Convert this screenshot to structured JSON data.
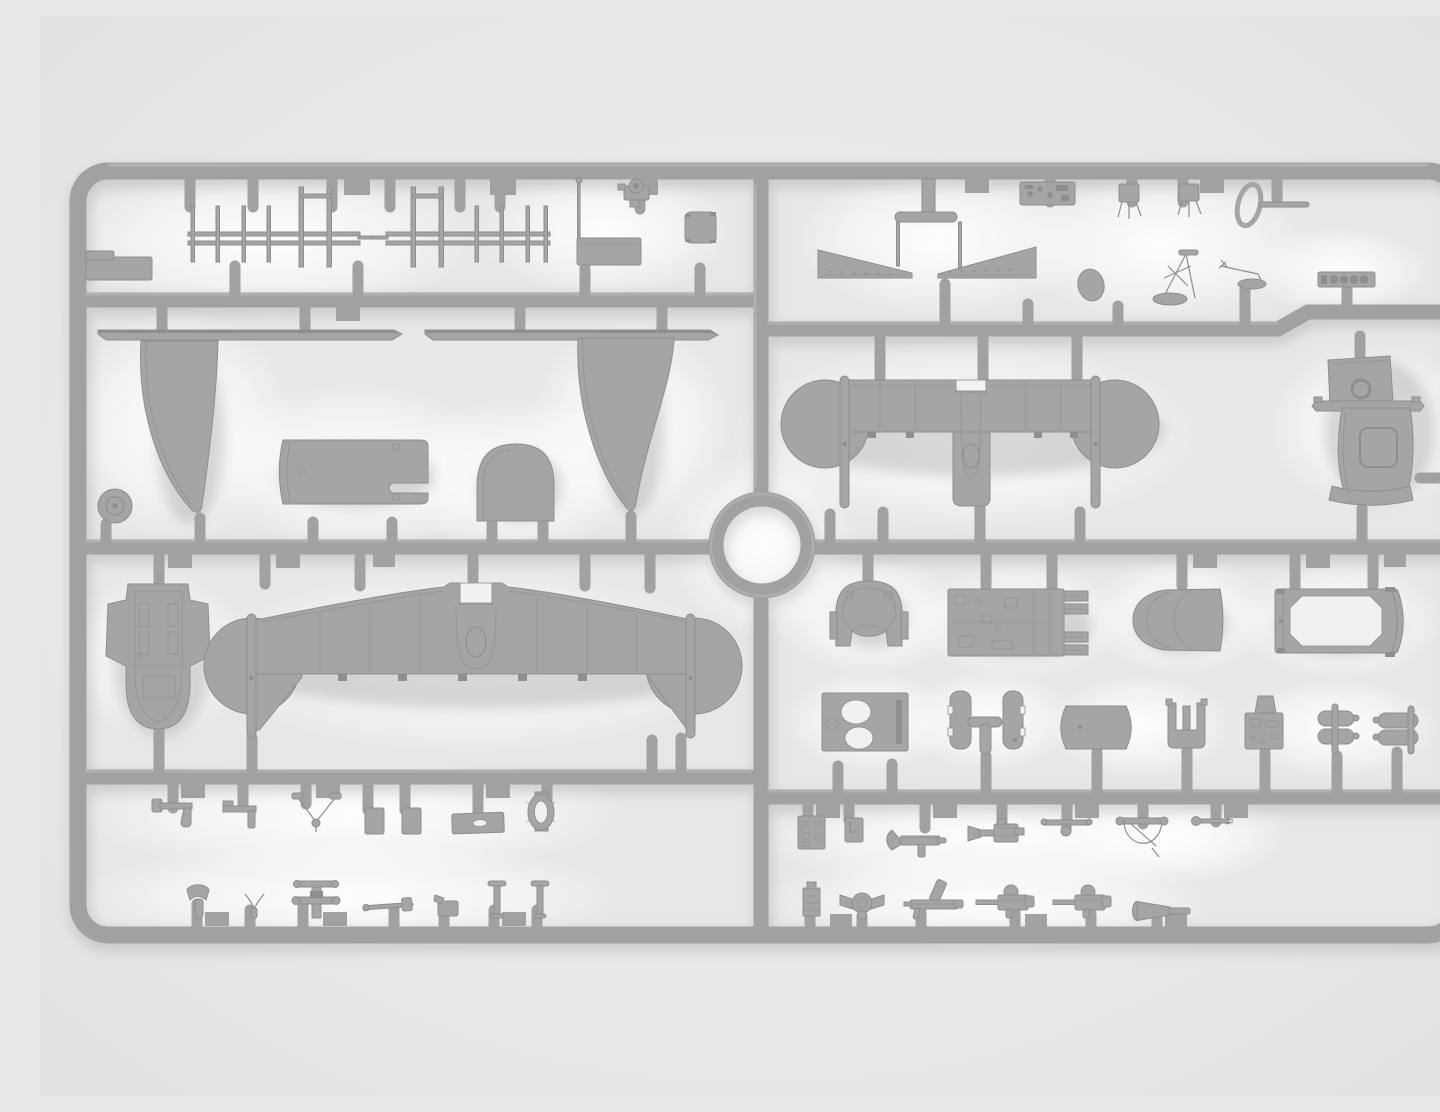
{
  "meta": {
    "description": "Gray injection-molded plastic model aircraft kit sprue, photographed flat on a light background: a rounded rectangular runner frame divided into eight compartments holding wings, fuselage sections, cowl parts, machine guns, antenna frames and small fittings, with a circular runner ring at the center."
  },
  "colors": {
    "background": "#e8e9ea",
    "background_edge": "#dfe0e2",
    "interior": "#e6e7e7",
    "glow": "#ffffff",
    "plastic": "#9fa1a2",
    "plastic_highlight": "#babbbc",
    "plastic_shadow": "#808184",
    "part": "#a4a5a6",
    "part_edge": "#8d8e90",
    "part_detail": "#8d8e90",
    "hole": "#f0f1f1"
  },
  "sprue": {
    "ring": {
      "present": true
    },
    "sections": [
      {
        "id": "top-left",
        "parts": [
          "step-plate",
          "ladder-antenna-left",
          "ladder-antenna-right",
          "box-with-mast",
          "pump-fitting",
          "square-pad"
        ]
      },
      {
        "id": "top-right",
        "parts": [
          "elevator-panel-left",
          "elevator-panel-right",
          "feed-tee",
          "instrument-panel",
          "seat-frame-1",
          "seat-frame-2",
          "oval-disc",
          "jack-tower",
          "davit-crane",
          "grab-ring",
          "gauge-strip"
        ]
      },
      {
        "id": "mid-left",
        "parts": [
          "leading-edge-strip-left",
          "leading-edge-strip-right",
          "float-wing-left",
          "float-wing-right",
          "cowl-wrap",
          "canopy-dome",
          "wheel"
        ]
      },
      {
        "id": "mid-right",
        "parts": [
          "upper-wing",
          "fuselage-panel-porthole",
          "tailplane-strip",
          "fuselage-panel-window"
        ]
      },
      {
        "id": "lower-left",
        "parts": [
          "fuselage-deck",
          "lower-wing"
        ]
      },
      {
        "id": "lower-right",
        "parts": [
          "headrest-cowl",
          "cockpit-floor",
          "nose-cone",
          "hatch-frame",
          "bulkhead-box",
          "door-panels",
          "cowl-panel",
          "u-bracket",
          "radio-box",
          "bomb-pair-1",
          "bomb-pair-2"
        ]
      },
      {
        "id": "bottom-left",
        "parts": [
          "bracket-1",
          "bracket-2",
          "wishbone",
          "plate-1",
          "plate-2",
          "panel-plate",
          "grommet",
          "seat-pan",
          "fork",
          "control-column",
          "gun-barrel",
          "pump-box",
          "t-post-1",
          "t-post-2"
        ]
      },
      {
        "id": "bottom-right",
        "parts": [
          "instrument-panel-square",
          "panel-square",
          "lewis-gun",
          "machine-gun-flash",
          "axle-rod",
          "ring-mount-quadrant",
          "lever",
          "ammo-box",
          "swivel-mount",
          "bipod-gun",
          "drum-gun-1",
          "drum-gun-2",
          "venturi-horn"
        ]
      }
    ]
  }
}
